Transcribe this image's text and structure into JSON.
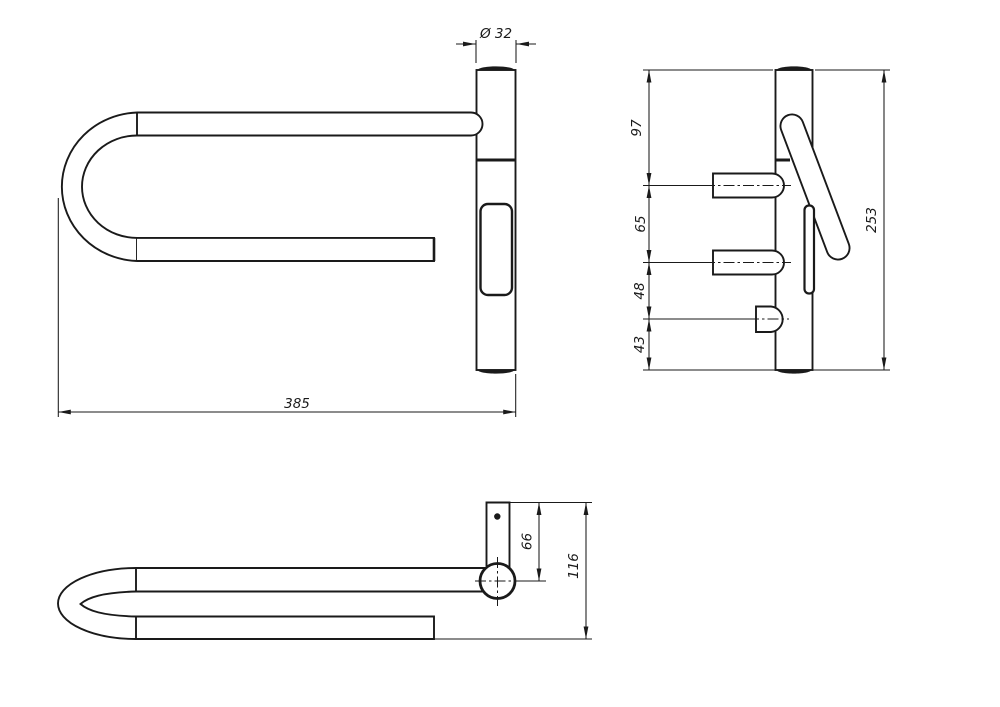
{
  "drawing": {
    "background_color": "#ffffff",
    "line_color": "#1a1a1a",
    "views": {
      "front": {
        "dim_diameter": "Ø 32",
        "dim_width": "385"
      },
      "side": {
        "dim_chain": [
          "97",
          "65",
          "48",
          "43"
        ],
        "dim_total_height": "253"
      },
      "plan": {
        "dim_offset": "66",
        "dim_depth": "116"
      }
    }
  }
}
